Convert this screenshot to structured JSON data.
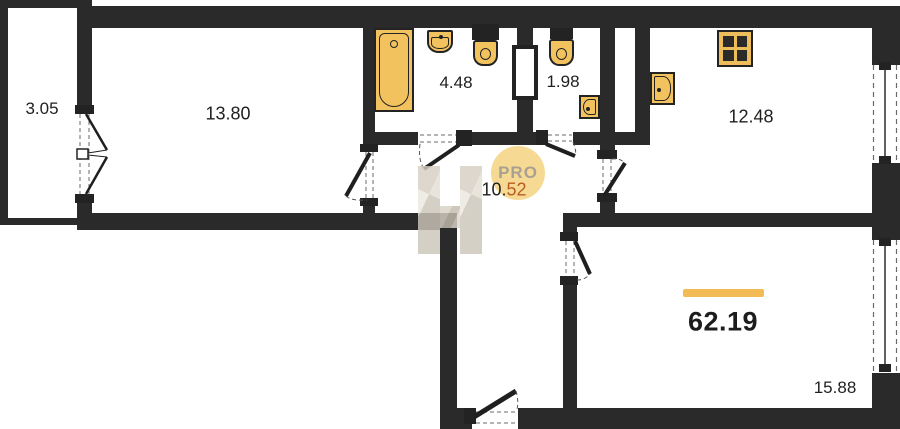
{
  "areas": {
    "balcony": "3.05",
    "living": "13.80",
    "bathroom": "4.48",
    "wc": "1.98",
    "kitchen": "12.48",
    "hall_int": "10.",
    "hall_frac": "52",
    "bedroom": "15.88",
    "total": "62.19"
  },
  "watermarks": {
    "pro_label": "PRO"
  },
  "colors": {
    "wall": "#2a2a2a",
    "fixture_fill": "#f2c25e",
    "accent_bar": "#f2bb55",
    "hall_frac_color": "#b95c22",
    "pro_circle": "#f6d88e"
  }
}
